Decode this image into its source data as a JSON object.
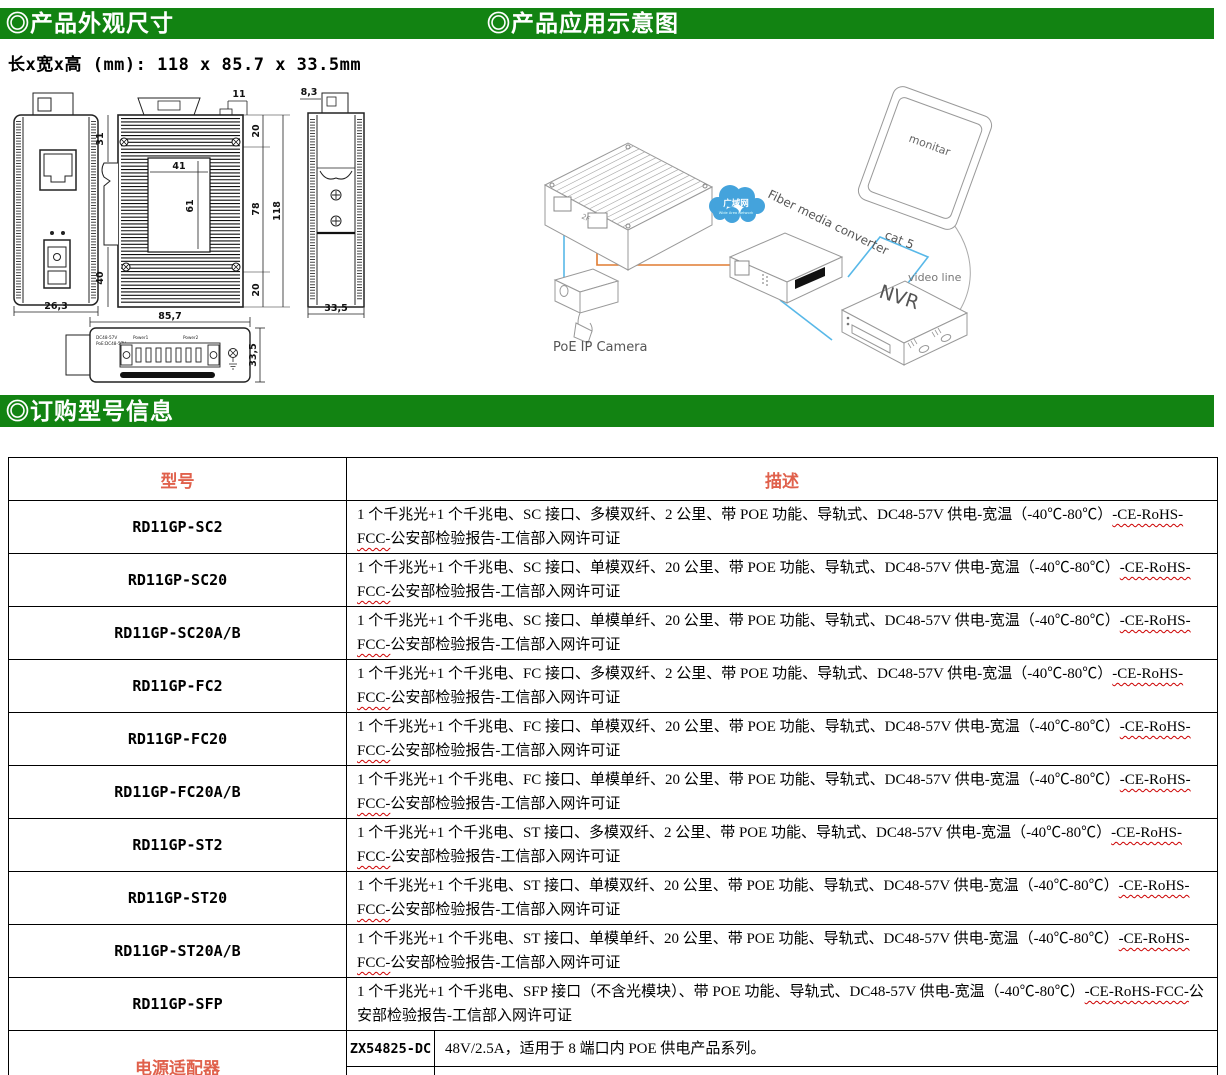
{
  "colors": {
    "header_green": "#128312",
    "accent_red": "#E0614C",
    "squiggle_red": "#CC0000",
    "cloud_blue": "#44A3DC",
    "cable_orange": "#E07B30",
    "cable_blue": "#58B8E8"
  },
  "headers": {
    "dim_title": "◎产品外观尺寸",
    "app_title": "◎产品应用示意图",
    "order_title": "◎订购型号信息"
  },
  "size_line": "长x宽x高 (mm): 118 x 85.7 x 33.5mm",
  "drawing": {
    "front_width": "26,3",
    "left_top": "31",
    "left_bottom": "40",
    "plate_w": "41",
    "plate_h": "61",
    "tab_w": "11",
    "right_top": "20",
    "right_mid": "78",
    "right_bottom": "20",
    "total_h": "118",
    "bottom_view_width": "85,7",
    "side_top": "8,3",
    "side_bottom": "33,5",
    "bottom_view_height": "33,5",
    "bv_text1": "DC48-57V",
    "bv_text2": "PoE:DC48-57V",
    "bv_power1": "Power1",
    "bv_power2": "Power2"
  },
  "diagram": {
    "camera": "PoE IP Camera",
    "cloud": "广域网",
    "cloud_sub": "Wide Area Network",
    "converter": "Fiber media converter",
    "monitor": "monitar",
    "nvr": "NVR",
    "cat5": "cat 5",
    "video": "video line",
    "port": "2F"
  },
  "table": {
    "col_model": "型号",
    "col_desc": "描述",
    "cert_sq": "-CE-RoHS-FCC-",
    "cert_rest": "公安部检验报告-工信部入网许可证",
    "rows": [
      {
        "model": "RD11GP-SC2",
        "d1": "1 个千兆光+1 个千兆电、SC 接口、多模双纤、2 公里、带 POE 功能、导轨式、DC48-57V 供电-宽温（-40℃-80℃）"
      },
      {
        "model": "RD11GP-SC20",
        "d1": "1 个千兆光+1 个千兆电、SC 接口、单模双纤、20 公里、带 POE 功能、导轨式、DC48-57V 供电-宽温（-40℃-80℃）"
      },
      {
        "model": "RD11GP-SC20A/B",
        "d1": "1 个千兆光+1 个千兆电、SC 接口、单模单纤、20 公里、带 POE 功能、导轨式、DC48-57V 供电-宽温（-40℃-80℃）"
      },
      {
        "model": "RD11GP-FC2",
        "d1": "1 个千兆光+1 个千兆电、FC 接口、多模双纤、2 公里、带 POE 功能、导轨式、DC48-57V 供电-宽温（-40℃-80℃）"
      },
      {
        "model": "RD11GP-FC20",
        "d1": "1 个千兆光+1 个千兆电、FC 接口、单模双纤、20 公里、带 POE 功能、导轨式、DC48-57V 供电-宽温（-40℃-80℃）"
      },
      {
        "model": "RD11GP-FC20A/B",
        "d1": "1 个千兆光+1 个千兆电、FC 接口、单模单纤、20 公里、带 POE 功能、导轨式、DC48-57V 供电-宽温（-40℃-80℃）"
      },
      {
        "model": "RD11GP-ST2",
        "d1": "1 个千兆光+1 个千兆电、ST 接口、多模双纤、2 公里、带 POE 功能、导轨式、DC48-57V 供电-宽温（-40℃-80℃）"
      },
      {
        "model": "RD11GP-ST20",
        "d1": "1 个千兆光+1 个千兆电、ST 接口、单模双纤、20 公里、带 POE 功能、导轨式、DC48-57V 供电-宽温（-40℃-80℃）"
      },
      {
        "model": "RD11GP-ST20A/B",
        "d1": "1 个千兆光+1 个千兆电、ST 接口、单模单纤、20 公里、带 POE 功能、导轨式、DC48-57V 供电-宽温（-40℃-80℃）"
      },
      {
        "model": "RD11GP-SFP",
        "d1": "1 个千兆光+1 个千兆电、SFP 接口（不含光模块）、带 POE 功能、导轨式、DC48-57V 供电-宽温（-40℃-80℃）"
      }
    ],
    "adapter": {
      "label": "电源适配器",
      "items": [
        {
          "model": "ZX54825-DC",
          "desc": "48V/2.5A，适用于 8 端口内 POE 供电产品系列。"
        },
        {
          "model": "ZX55223-DC",
          "desc": "52V/2.3A，适用于 8 端口内 POE 供电产品系列。"
        }
      ]
    }
  }
}
